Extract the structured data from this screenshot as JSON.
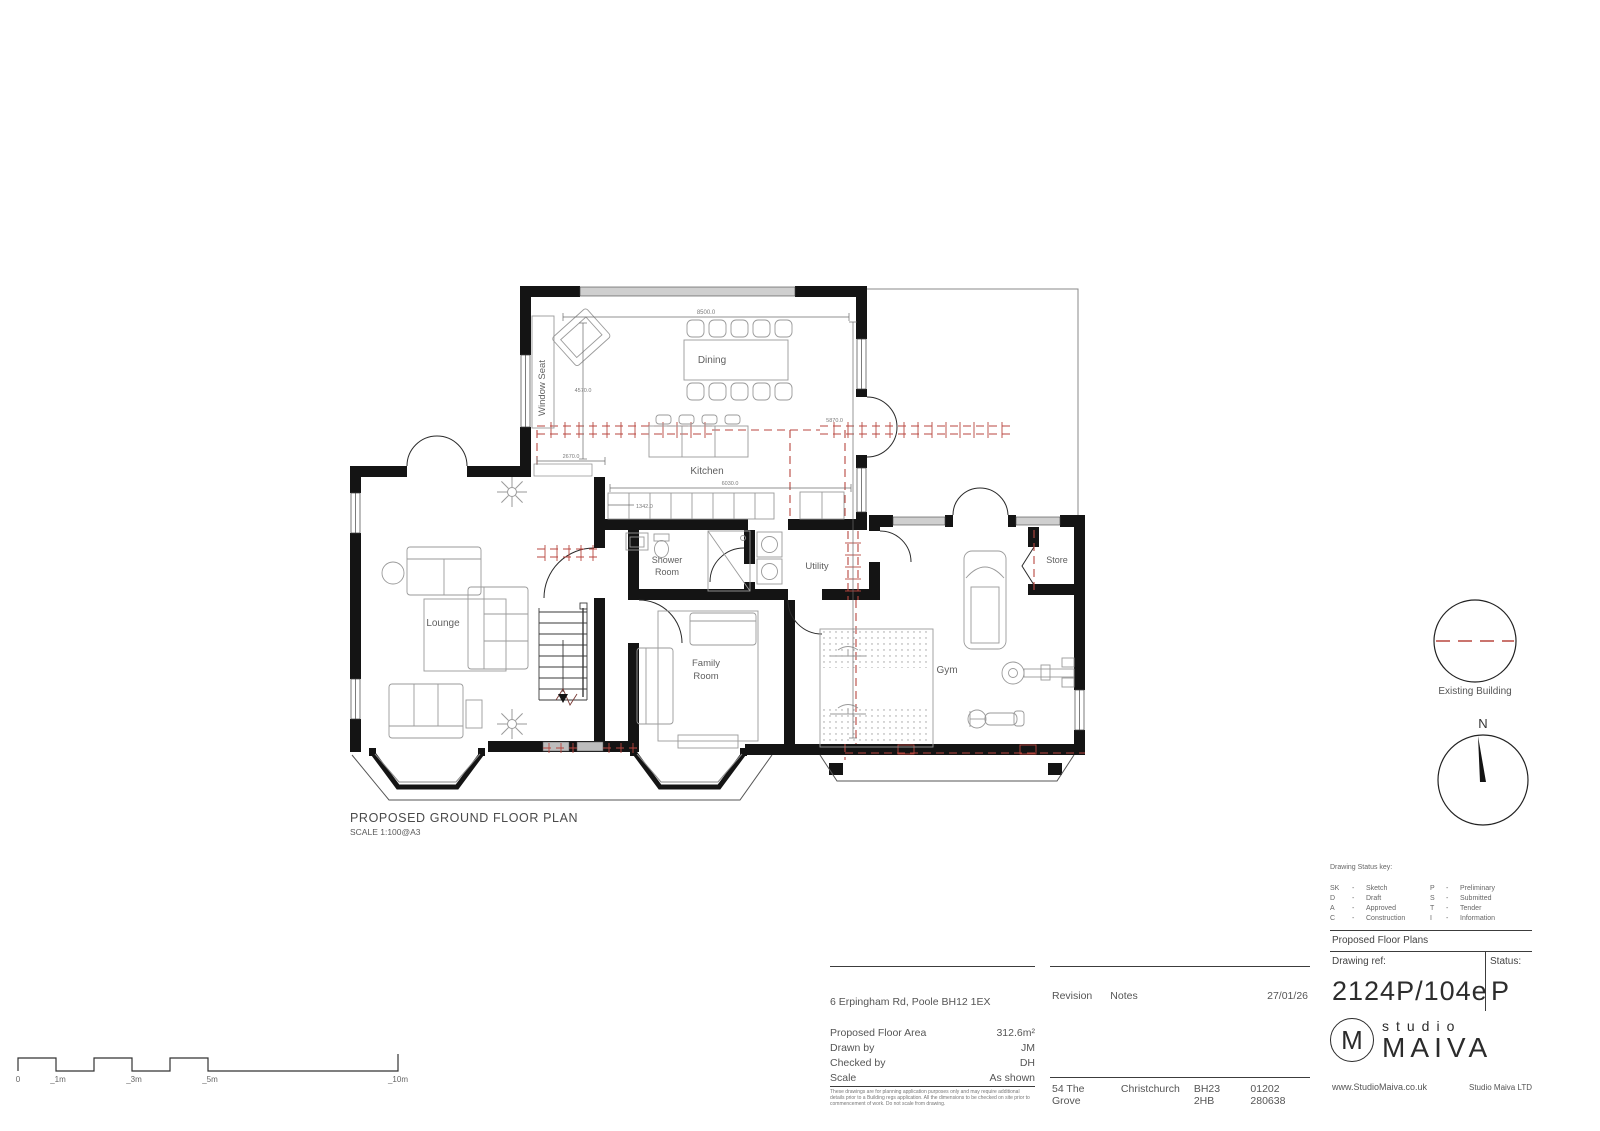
{
  "plan": {
    "title": "PROPOSED GROUND FLOOR PLAN",
    "scale": "SCALE 1:100@A3",
    "rooms": {
      "window_seat": "Window Seat",
      "dining": "Dining",
      "kitchen": "Kitchen",
      "lounge": "Lounge",
      "shower_room_line1": "Shower",
      "shower_room_line2": "Room",
      "utility": "Utility",
      "family_room_line1": "Family",
      "family_room_line2": "Room",
      "gym": "Gym",
      "store": "Store"
    },
    "dimensions": {
      "dining_width": "8500.0",
      "dining_height": "4570.0",
      "right_height": "5870.0",
      "hall_width": "2670.0",
      "kitchen_width": "6030.0",
      "kitchen_depth": "1342.0"
    },
    "north_label": "N",
    "existing_building_label": "Existing Building",
    "scale_bar": {
      "l0": "0",
      "l1": "_1m",
      "l2": "_3m",
      "l3": "_5m",
      "l4": "_10m"
    }
  },
  "info": {
    "address": "6 Erpingham Rd, Poole BH12 1EX",
    "rows": [
      {
        "label": "Proposed Floor Area",
        "value": "312.6m²"
      },
      {
        "label": "Drawn by",
        "value": "JM"
      },
      {
        "label": "Checked by",
        "value": "DH"
      },
      {
        "label": "Scale",
        "value": "As shown"
      }
    ],
    "disclaimer": "These drawings are for planning application purposes only and may require additional details prior to a Building regs application. All the dimensions to be checked on site prior to commencement of work. Do not scale from drawing."
  },
  "revision": {
    "revision_label": "Revision",
    "notes_label": "Notes",
    "date": "27/01/26",
    "street": "54 The Grove",
    "town": "Christchurch",
    "postcode": "BH23 2HB",
    "phone": "01202 280638"
  },
  "title_block": {
    "status_key_title": "Drawing Status key:",
    "dash": "-",
    "keys_left": [
      {
        "code": "SK",
        "label": "Sketch"
      },
      {
        "code": "D",
        "label": "Draft"
      },
      {
        "code": "A",
        "label": "Approved"
      },
      {
        "code": "C",
        "label": "Construction"
      }
    ],
    "keys_right": [
      {
        "code": "P",
        "label": "Preliminary"
      },
      {
        "code": "S",
        "label": "Submitted"
      },
      {
        "code": "T",
        "label": "Tender"
      },
      {
        "code": "I",
        "label": "Information"
      }
    ],
    "section_title": "Proposed Floor Plans",
    "drawing_ref_label": "Drawing ref:",
    "status_label": "Status:",
    "drawing_ref": "2124P/104e",
    "status_value": "P",
    "brand_monogram": "M",
    "brand_studio": "studio",
    "brand_name": "MAIVA",
    "website": "www.StudioMaiva.co.uk",
    "company": "Studio Maiva LTD"
  }
}
